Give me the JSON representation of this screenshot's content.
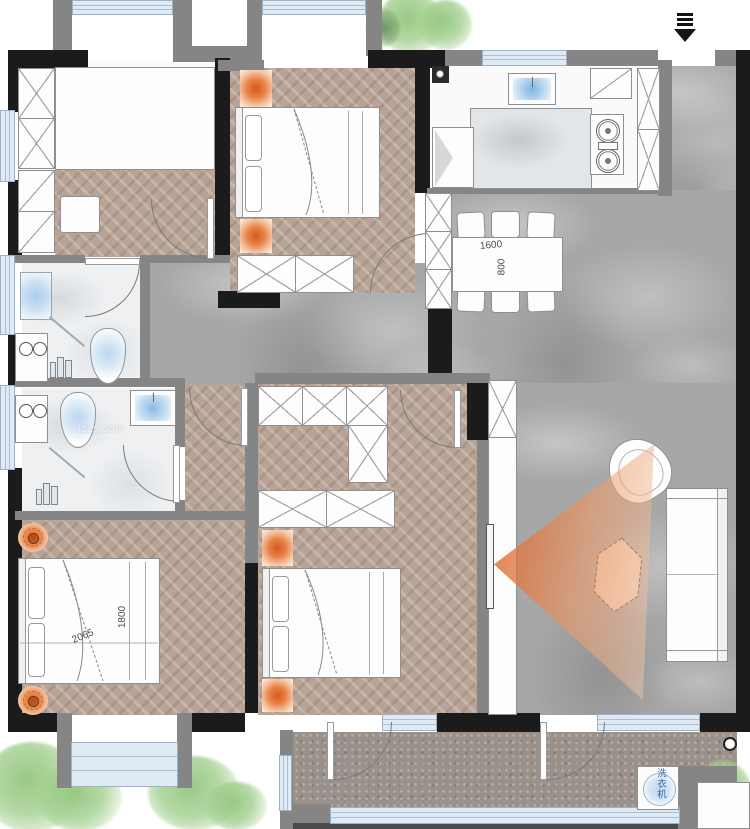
{
  "labels": {
    "dining_table_length": "1600",
    "dining_table_width": "800",
    "bed_diagonal": "2065",
    "bed_width": "1800",
    "washing_machine": "洗衣机",
    "watermark": ".fccs.com"
  },
  "icons": {
    "entry_arrow": "entry-direction-arrow",
    "washer_drum": "washing-machine-drum",
    "stove_burners": "gas-stove-two-burners",
    "kitchen_sink": "double-basin-sink"
  },
  "colors": {
    "wall_black": "#1b1b1b",
    "wall_gray": "#858585",
    "window_blue": "#dfeaf4",
    "wood_floor": "#b8a496",
    "tile_gray": "#a7a7a7",
    "bath_floor": "#eef0f2",
    "concrete": "#9a928a",
    "accent_orange": "#d6591c",
    "tree_green": "#94c67e",
    "label_blue": "#35639e"
  }
}
